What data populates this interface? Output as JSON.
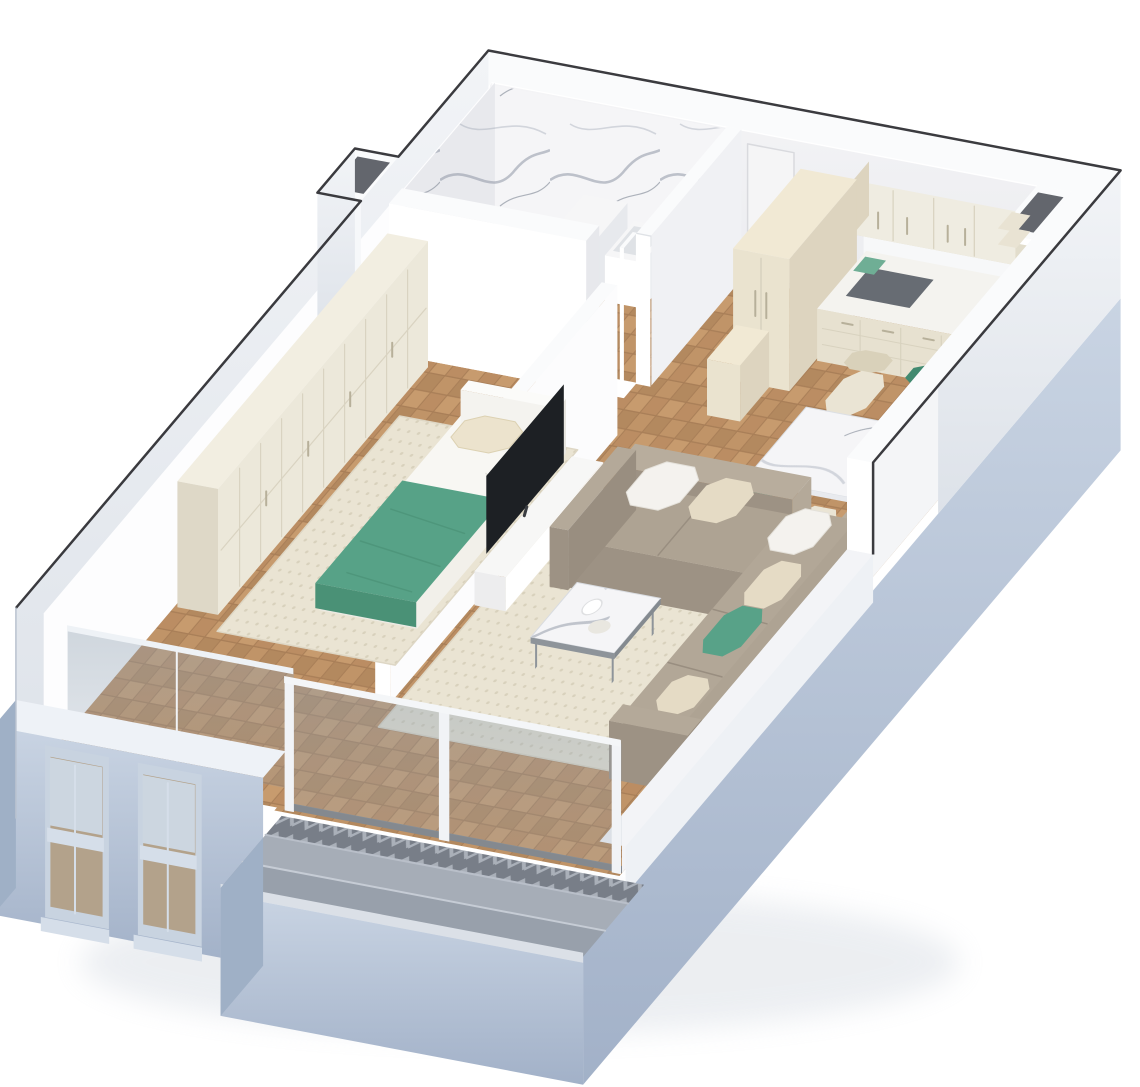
{
  "image": {
    "kind": "3d-floorplan-cutaway-render",
    "width_px": 1140,
    "height_px": 1087,
    "text_content": []
  },
  "scene": {
    "rooms": [
      {
        "name": "bathroom",
        "features": [
          "marble-clad-walls",
          "marble-shower-floor",
          "shower-bench",
          "wall-basin",
          "wall-hung-toilet"
        ]
      },
      {
        "name": "entry-hall",
        "features": [
          "entry-door",
          "parquet-floor"
        ]
      },
      {
        "name": "kitchen",
        "features": [
          "upper-cabinets",
          "open-shelves",
          "tall-fridge-cabinet",
          "counter-with-sink",
          "corner-duct-shaft"
        ]
      },
      {
        "name": "dining-area",
        "features": [
          "marble-dining-table",
          "two-green-chairs",
          "two-cream-chairs"
        ]
      },
      {
        "name": "bedroom",
        "features": [
          "wardrobe-wall",
          "double-bed",
          "green-throw",
          "cream-pillow",
          "beige-rug",
          "two-sash-windows",
          "juliet-glazing"
        ]
      },
      {
        "name": "living-room",
        "features": [
          "l-shaped-sectional-sofa",
          "throw-pillows",
          "marble-coffee-table",
          "tv-on-partition-wall",
          "media-console",
          "beige-rug",
          "glass-sliding-front"
        ]
      },
      {
        "name": "terrace",
        "features": [
          "chevron-border-strip",
          "stone-pavers",
          "low-curb"
        ]
      }
    ]
  },
  "palette": {
    "outline": "#26262a",
    "wall_top": "#fafbfc",
    "wall_bright": "#ffffff",
    "wall_face": "#f0f1f4",
    "wall_shade": "#e7e8ec",
    "back_light": "#f4f4f6",
    "back_shade": "#e9eaee",
    "ext_light": "#f2f4f7",
    "ext_shade": "#dde2e9",
    "facade_light": "#c9d4e3",
    "facade_dark": "#a2b1c8",
    "facade_side": "#9fb0c6",
    "win_frame": "#c8d3e0",
    "win_rail": "#d5dee9",
    "win_glass": "#b3a28b",
    "win_glass_hi": "#ccd6e0",
    "hole_dark": "#63666d",
    "wood_base": "#a97f58",
    "wood_a": "#c09468",
    "wood_b": "#b3895f",
    "wood_c": "#bb8d63",
    "wood_d": "#c79b6e",
    "rug_base": "#eae4d3",
    "rug_dot": "#d8d1bc",
    "rug_edge": "#ded7c5",
    "marble_base": "#f5f5f7",
    "marble_vein": "#b3b8c2",
    "marble_vein2": "#d2d5dc",
    "marble_vein3": "#8f96a2",
    "chevron_dark": "#787e88",
    "chevron_light": "#aab0b9",
    "paver_a": "#a6adb7",
    "paver_b": "#98a0ab",
    "paver_joint": "#c6ccd5",
    "paver_joint2": "#b9bfc9",
    "curb": "#dbe0e7",
    "glass_tint": "#8fa0b0",
    "glass_edge": "#eef2f6",
    "track": "#84898f",
    "mullion": "#f1f3f6",
    "rail": "#f4f6f8",
    "cab_cream": "#eae3cf",
    "cab_cream_top": "#f1e9d4",
    "cab_cream_side": "#ddd4bf",
    "cab_upper": "#efece1",
    "cab_upper_bottom": "#e2ddcc",
    "cab_seam": "#d8d2bf",
    "handle": "#b7b09a",
    "shelf": "#e9e3d3",
    "counter_top": "#f4f3ef",
    "counter_face": "#e7e1d0",
    "counter_side": "#d9d2bf",
    "sink_dark": "#676c73",
    "board_green": "#6fae95",
    "door_leaf": "#f5f5f6",
    "door_frame": "#d9dade",
    "door_handle": "#b9bcc2",
    "fixture_top": "#f6f6f7",
    "fixture_face": "#ffffff",
    "fixture_side": "#e7e9ed",
    "fixture_inset": "#dfe2e6",
    "wardrobe_front": "#ece8da",
    "wardrobe_top": "#f2eee1",
    "wardrobe_side": "#ded8c7",
    "wardrobe_seam": "#d9d3c1",
    "bed_white": "#f8f7f3",
    "bed_face": "#edebe5",
    "bed_side": "#f2f0ea",
    "headboard": "#f4f3ef",
    "pillow_cream": "#ece3cd",
    "pillow_edge": "#dcd1b2",
    "throw_green": "#57a287",
    "throw_dark": "#4a9176",
    "duvet_fold": "#e4e2db",
    "table_leg": "#3b3c40",
    "table_edge": "#e8eaee",
    "table_edge2": "#dfe2e7",
    "chair_green": "#54a086",
    "chair_green_dark": "#428a70",
    "chair_cream": "#eae4d4",
    "chair_cream_dark": "#d9d1ba",
    "chair_leg": "#c8ae85",
    "sofa_top": "#aea393",
    "sofa_top2": "#b2a797",
    "sofa_front": "#9d9284",
    "sofa_back": "#b8ad9d",
    "sofa_arm": "#b4a999",
    "sofa_seam": "#998e80",
    "pil_white": "#f4f2ee",
    "pil_cream": "#e5dbc5",
    "pil_green": "#58a288",
    "pil_edge": "#e4e1da",
    "coffee_frame": "#8e949a",
    "coffee_frame2": "#848a90",
    "obj_white": "#ffffff",
    "obj_cream": "#e9e7e0",
    "tv_black": "#1d2024",
    "console_top": "#f7f7f6",
    "console_face": "#ffffff",
    "console_side": "#ededee",
    "shadow_soft": "#c9d0da"
  }
}
